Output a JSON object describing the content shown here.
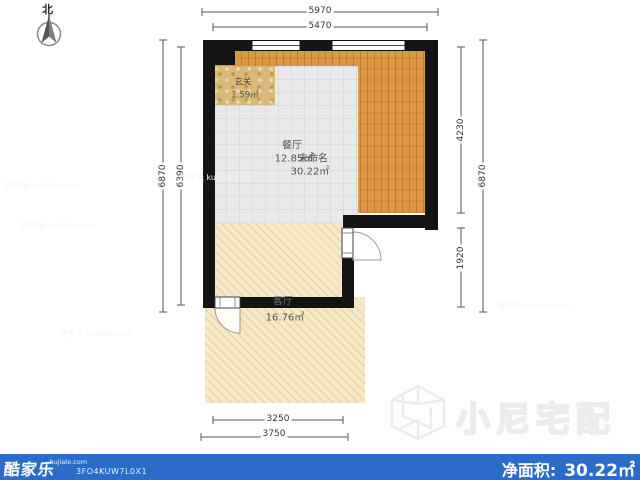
{
  "north": {
    "label": "北"
  },
  "dimensions": {
    "top_outer": "5970",
    "top_inner": "5470",
    "left_outer": "6870",
    "left_inner": "6390",
    "right_upper": "4230",
    "right_lower": "1920",
    "right_outer": "6870",
    "bottom_inner": "3250",
    "bottom_outer": "3750"
  },
  "rooms": {
    "entry": {
      "name": "玄关",
      "area": "1.59㎡"
    },
    "dining": {
      "name": "餐厅",
      "area": "12.85㎡"
    },
    "unnamed": {
      "name": "未命名",
      "area": "30.22㎡"
    },
    "living": {
      "name": "客厅",
      "area": "16.76㎡"
    }
  },
  "watermark": {
    "brand": "小尼宅配",
    "tile": "酷家乐 kujiale.com"
  },
  "footer": {
    "brand": "酷家乐",
    "brand_domain": "kujiale.com",
    "plan_code": "3FO4KUW7L0X1",
    "net_area_label": "净面积:",
    "net_area_value": "30.22㎡"
  },
  "colors": {
    "accent_blue": "#2b6cc8",
    "wall": "#141414",
    "wood": "#dd9843",
    "tile_gray": "#e9e9eb",
    "entry_tan": "#d9b878",
    "living_beige": "#f7e9c6"
  }
}
